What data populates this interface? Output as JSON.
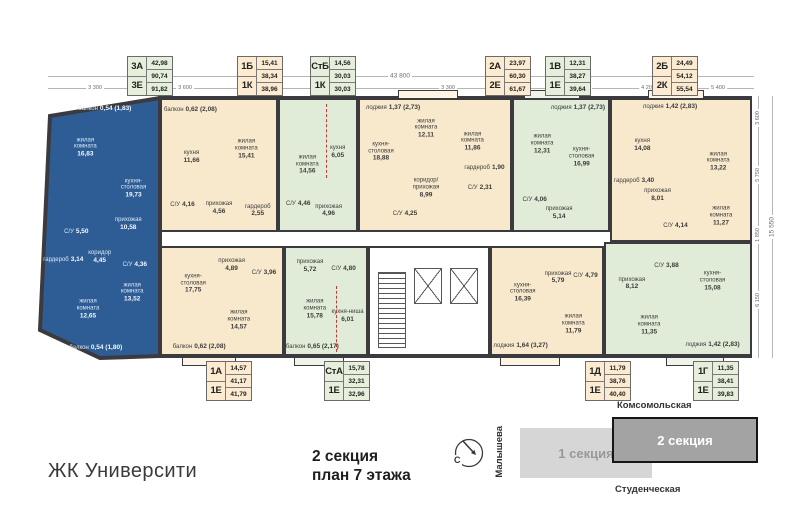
{
  "title": {
    "complex": "ЖК Университи",
    "plan_line1": "2 секция",
    "plan_line2": "план 7 этажа"
  },
  "colors": {
    "blue": "#2e5d95",
    "beige": "#f8e9cd",
    "green": "#e0ecd7",
    "card_beige": "#fcebd1",
    "card_green": "#e6efdc",
    "wall": "#3b3b3f",
    "balcony_beige": "#fdf4e3",
    "balcony_green": "#eef4e8",
    "map_section1": "#d6d6d6",
    "map_section2": "#a3a3a3"
  },
  "cards": [
    {
      "key": "3A",
      "type_top": "3А",
      "type_bottom": "3Е",
      "values": [
        "42,98",
        "90,74",
        "91,82"
      ],
      "tone": "green",
      "row": "top",
      "x": 127
    },
    {
      "key": "1B",
      "type_top": "1Б",
      "type_bottom": "1К",
      "values": [
        "15,41",
        "38,34",
        "38,96"
      ],
      "tone": "beige",
      "row": "top",
      "x": 237
    },
    {
      "key": "StB",
      "type_top": "СтБ",
      "type_bottom": "1К",
      "values": [
        "14,56",
        "30,03",
        "30,03"
      ],
      "tone": "green",
      "row": "top",
      "x": 310
    },
    {
      "key": "2A",
      "type_top": "2А",
      "type_bottom": "2Е",
      "values": [
        "23,97",
        "60,30",
        "61,67"
      ],
      "tone": "beige",
      "row": "top",
      "x": 485
    },
    {
      "key": "1V",
      "type_top": "1В",
      "type_bottom": "1Е",
      "values": [
        "12,31",
        "38,27",
        "39,64"
      ],
      "tone": "green",
      "row": "top",
      "x": 545
    },
    {
      "key": "2B",
      "type_top": "2Б",
      "type_bottom": "2К",
      "values": [
        "24,49",
        "54,12",
        "55,54"
      ],
      "tone": "beige",
      "row": "top",
      "x": 652
    },
    {
      "key": "1A",
      "type_top": "1А",
      "type_bottom": "1Е",
      "values": [
        "14,57",
        "41,17",
        "41,79"
      ],
      "tone": "beige",
      "row": "bottom",
      "x": 206
    },
    {
      "key": "StA",
      "type_top": "СтА",
      "type_bottom": "1Е",
      "values": [
        "15,78",
        "32,31",
        "32,96"
      ],
      "tone": "green",
      "row": "bottom",
      "x": 324
    },
    {
      "key": "1D",
      "type_top": "1Д",
      "type_bottom": "1Е",
      "values": [
        "11,79",
        "38,76",
        "40,40"
      ],
      "tone": "beige",
      "row": "bottom",
      "x": 585
    },
    {
      "key": "1G",
      "type_top": "1Г",
      "type_bottom": "1Е",
      "values": [
        "11,35",
        "38,41",
        "39,83"
      ],
      "tone": "green",
      "row": "bottom",
      "x": 693
    }
  ],
  "apartments": [
    {
      "key": "3E",
      "tone": "blue",
      "shape": "poly",
      "x": 36,
      "y": 90,
      "w": 130,
      "h": 274,
      "points": "14,26 124,8 124,266 64,268 4,240",
      "rooms": [
        {
          "n": "балкон",
          "a": "0,54 (1,83)",
          "x": 53,
          "y": 7,
          "inline": true
        },
        {
          "n": "жилая комната",
          "a": "16,83",
          "x": 38,
          "y": 21
        },
        {
          "n": "кухня-столовая",
          "a": "19,73",
          "x": 75,
          "y": 36
        },
        {
          "n": "прихожая",
          "a": "10,58",
          "x": 71,
          "y": 49
        },
        {
          "n": "С/У",
          "a": "5,50",
          "x": 31,
          "y": 52,
          "inline": true
        },
        {
          "n": "гардероб",
          "a": "3,14",
          "x": 21,
          "y": 62,
          "inline": true
        },
        {
          "n": "коридор",
          "a": "4,45",
          "x": 49,
          "y": 61
        },
        {
          "n": "С/У",
          "a": "4,36",
          "x": 76,
          "y": 64,
          "inline": true
        },
        {
          "n": "жилая комната",
          "a": "12,65",
          "x": 40,
          "y": 80
        },
        {
          "n": "жилая комната",
          "a": "13,52",
          "x": 74,
          "y": 74
        },
        {
          "n": "балкон",
          "a": "0,54 (1,80)",
          "x": 46,
          "y": 94,
          "inline": true
        }
      ]
    },
    {
      "key": "1B",
      "tone": "beige",
      "x": 160,
      "y": 98,
      "w": 118,
      "h": 134,
      "rooms": [
        {
          "n": "балкон",
          "a": "0,62 (2,08)",
          "x": 25,
          "y": 8,
          "inline": true
        },
        {
          "n": "кухня",
          "a": "11,66",
          "x": 26,
          "y": 44
        },
        {
          "n": "жилая комната",
          "a": "15,41",
          "x": 74,
          "y": 38
        },
        {
          "n": "С/У",
          "a": "4,16",
          "x": 18,
          "y": 81,
          "inline": true
        },
        {
          "n": "прихожая",
          "a": "4,56",
          "x": 50,
          "y": 83
        },
        {
          "n": "гардероб",
          "a": "2,55",
          "x": 84,
          "y": 85
        }
      ]
    },
    {
      "key": "StB",
      "tone": "green",
      "x": 278,
      "y": 98,
      "w": 80,
      "h": 134,
      "rooms": [
        {
          "n": "жилая комната",
          "a": "14,56",
          "x": 36,
          "y": 50
        },
        {
          "n": "кухня",
          "a": "6,05",
          "x": 76,
          "y": 40
        },
        {
          "n": "С/У",
          "a": "4,46",
          "x": 24,
          "y": 80,
          "inline": true
        },
        {
          "n": "прихожая",
          "a": "4,96",
          "x": 64,
          "y": 85
        }
      ]
    },
    {
      "key": "2A",
      "tone": "beige",
      "x": 358,
      "y": 98,
      "w": 154,
      "h": 134,
      "rooms": [
        {
          "n": "лоджия",
          "a": "1,37 (2,73)",
          "x": 22,
          "y": 6,
          "inline": true
        },
        {
          "n": "кухня-столовая",
          "a": "18,88",
          "x": 14,
          "y": 40
        },
        {
          "n": "жилая комната",
          "a": "12,11",
          "x": 44,
          "y": 22
        },
        {
          "n": "жилая комната",
          "a": "11,86",
          "x": 75,
          "y": 32
        },
        {
          "n": "коридор/прихожая",
          "a": "8,99",
          "x": 44,
          "y": 68
        },
        {
          "n": "С/У",
          "a": "4,25",
          "x": 30,
          "y": 88,
          "inline": true
        },
        {
          "n": "С/У",
          "a": "2,31",
          "x": 80,
          "y": 68,
          "inline": true
        },
        {
          "n": "гардероб",
          "a": "1,90",
          "x": 83,
          "y": 52,
          "inline": true
        }
      ]
    },
    {
      "key": "1V",
      "tone": "green",
      "x": 512,
      "y": 98,
      "w": 98,
      "h": 134,
      "rooms": [
        {
          "n": "лоджия",
          "a": "1,37 (2,73)",
          "x": 68,
          "y": 6,
          "inline": true
        },
        {
          "n": "жилая комната",
          "a": "12,31",
          "x": 30,
          "y": 34
        },
        {
          "n": "кухня-столовая",
          "a": "16,99",
          "x": 72,
          "y": 44
        },
        {
          "n": "С/У",
          "a": "4,06",
          "x": 22,
          "y": 77,
          "inline": true
        },
        {
          "n": "прихожая",
          "a": "5,14",
          "x": 48,
          "y": 87
        }
      ]
    },
    {
      "key": "2B",
      "tone": "beige",
      "x": 610,
      "y": 98,
      "w": 142,
      "h": 144,
      "rooms": [
        {
          "n": "лоджия",
          "a": "1,42 (2,83)",
          "x": 42,
          "y": 5,
          "inline": true
        },
        {
          "n": "кухня",
          "a": "14,08",
          "x": 22,
          "y": 32
        },
        {
          "n": "жилая комната",
          "a": "13,22",
          "x": 77,
          "y": 44
        },
        {
          "n": "гардероб",
          "a": "3,40",
          "x": 16,
          "y": 58,
          "inline": true
        },
        {
          "n": "прихожая",
          "a": "8,01",
          "x": 33,
          "y": 68
        },
        {
          "n": "С/У",
          "a": "4,14",
          "x": 46,
          "y": 90,
          "inline": true
        },
        {
          "n": "жилая комната",
          "a": "11,27",
          "x": 79,
          "y": 83
        }
      ]
    },
    {
      "key": "1A",
      "tone": "beige",
      "x": 160,
      "y": 246,
      "w": 124,
      "h": 110,
      "rooms": [
        {
          "n": "кухня-столовая",
          "a": "17,75",
          "x": 26,
          "y": 34
        },
        {
          "n": "прихожая",
          "a": "4,89",
          "x": 58,
          "y": 16
        },
        {
          "n": "С/У",
          "a": "3,96",
          "x": 85,
          "y": 24,
          "inline": true
        },
        {
          "n": "жилая комната",
          "a": "14,57",
          "x": 64,
          "y": 68
        },
        {
          "n": "балкон",
          "a": "0,62 (2,08)",
          "x": 31,
          "y": 93,
          "inline": true
        }
      ]
    },
    {
      "key": "StA",
      "tone": "green",
      "x": 284,
      "y": 246,
      "w": 84,
      "h": 110,
      "rooms": [
        {
          "n": "прихожая",
          "a": "5,72",
          "x": 30,
          "y": 17
        },
        {
          "n": "С/У",
          "a": "4,80",
          "x": 72,
          "y": 20,
          "inline": true
        },
        {
          "n": "жилая комната",
          "a": "15,78",
          "x": 36,
          "y": 58
        },
        {
          "n": "кухня-ниша",
          "a": "6,01",
          "x": 77,
          "y": 64
        },
        {
          "n": "балкон",
          "a": "0,65 (2,17)",
          "x": 33,
          "y": 93,
          "inline": true
        }
      ]
    },
    {
      "key": "1D",
      "tone": "beige",
      "x": 490,
      "y": 246,
      "w": 114,
      "h": 110,
      "rooms": [
        {
          "n": "кухня-столовая",
          "a": "16,39",
          "x": 28,
          "y": 42
        },
        {
          "n": "прихожая",
          "a": "5,79",
          "x": 60,
          "y": 28
        },
        {
          "n": "С/У",
          "a": "4,79",
          "x": 85,
          "y": 26,
          "inline": true
        },
        {
          "n": "жилая комната",
          "a": "11,79",
          "x": 74,
          "y": 72
        },
        {
          "n": "лоджия",
          "a": "1,64 (3,27)",
          "x": 26,
          "y": 92,
          "inline": true
        }
      ]
    },
    {
      "key": "1G",
      "tone": "green",
      "x": 604,
      "y": 242,
      "w": 148,
      "h": 114,
      "rooms": [
        {
          "n": "прихожая",
          "a": "8,12",
          "x": 18,
          "y": 36
        },
        {
          "n": "С/У",
          "a": "3,88",
          "x": 42,
          "y": 20,
          "inline": true
        },
        {
          "n": "кухня-столовая",
          "a": "15,08",
          "x": 74,
          "y": 34
        },
        {
          "n": "жилая комната",
          "a": "11,35",
          "x": 30,
          "y": 74
        },
        {
          "n": "лоджия",
          "a": "1,42 (2,83)",
          "x": 74,
          "y": 92,
          "inline": true
        }
      ]
    }
  ],
  "dimensions": {
    "overall_top": "43 800",
    "top_segments": [
      {
        "label": "3 300",
        "x": 95
      },
      {
        "label": "3 600",
        "x": 185
      },
      {
        "label": "3 600",
        "x": 250
      },
      {
        "label": "6 000",
        "x": 330
      },
      {
        "label": "3 300",
        "x": 448
      },
      {
        "label": "2 500",
        "x": 518
      },
      {
        "label": "3 300",
        "x": 583
      },
      {
        "label": "4 200",
        "x": 648
      },
      {
        "label": "5 400",
        "x": 718
      }
    ],
    "right_segments": [
      {
        "label": "3 600",
        "y": 118
      },
      {
        "label": "5 750",
        "y": 175
      },
      {
        "label": "1 850",
        "y": 235
      },
      {
        "label": "6 150",
        "y": 300
      }
    ],
    "overall_right": "15 550"
  },
  "map": {
    "street_top": "Комсомольская",
    "street_bottom": "Студенческая",
    "street_left": "Малышева",
    "section1": "1 секция",
    "section2": "2 секция",
    "compass": "С"
  }
}
